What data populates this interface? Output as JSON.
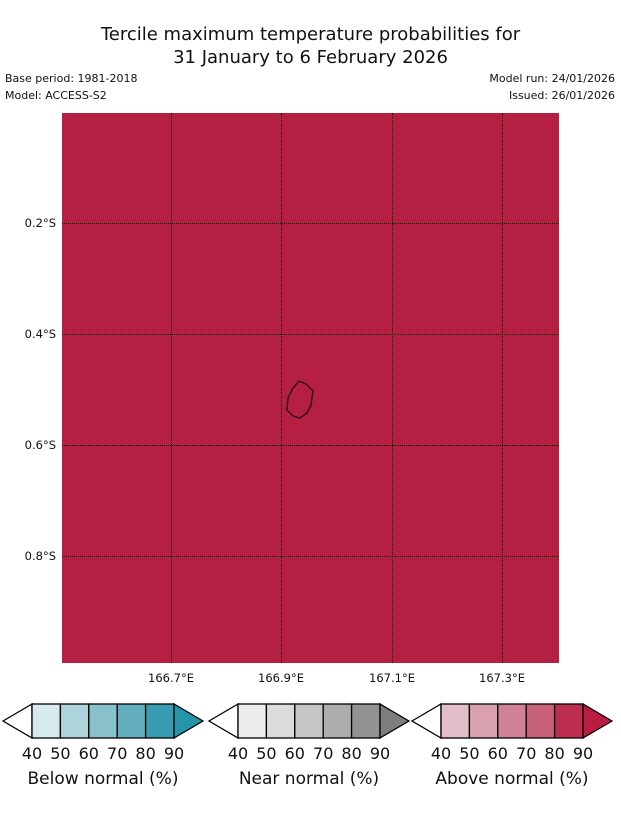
{
  "title": {
    "line1": "Tercile maximum temperature probabilities for",
    "line2": "31 January to 6 February 2026"
  },
  "meta": {
    "base_period": "Base period: 1981-2018",
    "model": "Model: ACCESS-S2",
    "model_run": "Model run: 24/01/2026",
    "issued": "Issued: 26/01/2026"
  },
  "map": {
    "fill_color": "#b51f42",
    "island_outline_color": "#2d0e1a",
    "copyright": "© Commonwealth of Australia 2026, Bureau of Meteorology, supported by COSPPac",
    "y_ticks": [
      "0.2°S",
      "0.4°S",
      "0.6°S",
      "0.8°S"
    ],
    "x_ticks": [
      "166.7°E",
      "166.9°E",
      "167.1°E",
      "167.3°E"
    ]
  },
  "legends": [
    {
      "label": "Below normal (%)",
      "ticks": [
        "40",
        "50",
        "60",
        "70",
        "80",
        "90"
      ],
      "colors": [
        "#d6e9ed",
        "#aed4db",
        "#88c1cc",
        "#62aebe",
        "#3a9cb0"
      ],
      "left_arrow_color": "#ffffff",
      "arrow_color": "#2695aa"
    },
    {
      "label": "Near normal (%)",
      "ticks": [
        "40",
        "50",
        "60",
        "70",
        "80",
        "90"
      ],
      "colors": [
        "#ececec",
        "#dbdbdb",
        "#c6c6c6",
        "#adadad",
        "#929292"
      ],
      "left_arrow_color": "#ffffff",
      "arrow_color": "#7d7d7d"
    },
    {
      "label": "Above normal (%)",
      "ticks": [
        "40",
        "50",
        "60",
        "70",
        "80",
        "90"
      ],
      "colors": [
        "#e2bec9",
        "#d9a1b0",
        "#d08296",
        "#c8617a",
        "#bd2d50"
      ],
      "left_arrow_color": "#ffffff",
      "arrow_color": "#b91d42"
    }
  ],
  "chart_data": {
    "type": "heatmap",
    "title": "Tercile maximum temperature probabilities for 31 January to 6 February 2026",
    "base_period": "1981-2018",
    "model": "ACCESS-S2",
    "model_run": "24/01/2026",
    "issued": "26/01/2026",
    "x_axis": {
      "ticks": [
        "166.7°E",
        "166.9°E",
        "167.1°E",
        "167.3°E"
      ],
      "range_deg_e": [
        166.5,
        167.4
      ]
    },
    "y_axis": {
      "ticks": [
        "0.2°S",
        "0.4°S",
        "0.6°S",
        "0.8°S"
      ],
      "range_deg_s": [
        0.0,
        1.0
      ]
    },
    "grid": true,
    "field": {
      "uniform": true,
      "category": "Above normal",
      "probability_percent": ">90",
      "fill_color": "#b51f42"
    },
    "island_outline_center": {
      "lon_e": 166.93,
      "lat_s": 0.52
    },
    "colorbars": [
      {
        "label": "Below normal (%)",
        "bin_edges": [
          40,
          50,
          60,
          70,
          80,
          90
        ],
        "colors": [
          "#d6e9ed",
          "#aed4db",
          "#88c1cc",
          "#62aebe",
          "#3a9cb0"
        ],
        "over_color": "#2695aa"
      },
      {
        "label": "Near normal (%)",
        "bin_edges": [
          40,
          50,
          60,
          70,
          80,
          90
        ],
        "colors": [
          "#ececec",
          "#dbdbdb",
          "#c6c6c6",
          "#adadad",
          "#929292"
        ],
        "over_color": "#7d7d7d"
      },
      {
        "label": "Above normal (%)",
        "bin_edges": [
          40,
          50,
          60,
          70,
          80,
          90
        ],
        "colors": [
          "#e2bec9",
          "#d9a1b0",
          "#d08296",
          "#c8617a",
          "#bd2d50"
        ],
        "over_color": "#b91d42"
      }
    ]
  }
}
